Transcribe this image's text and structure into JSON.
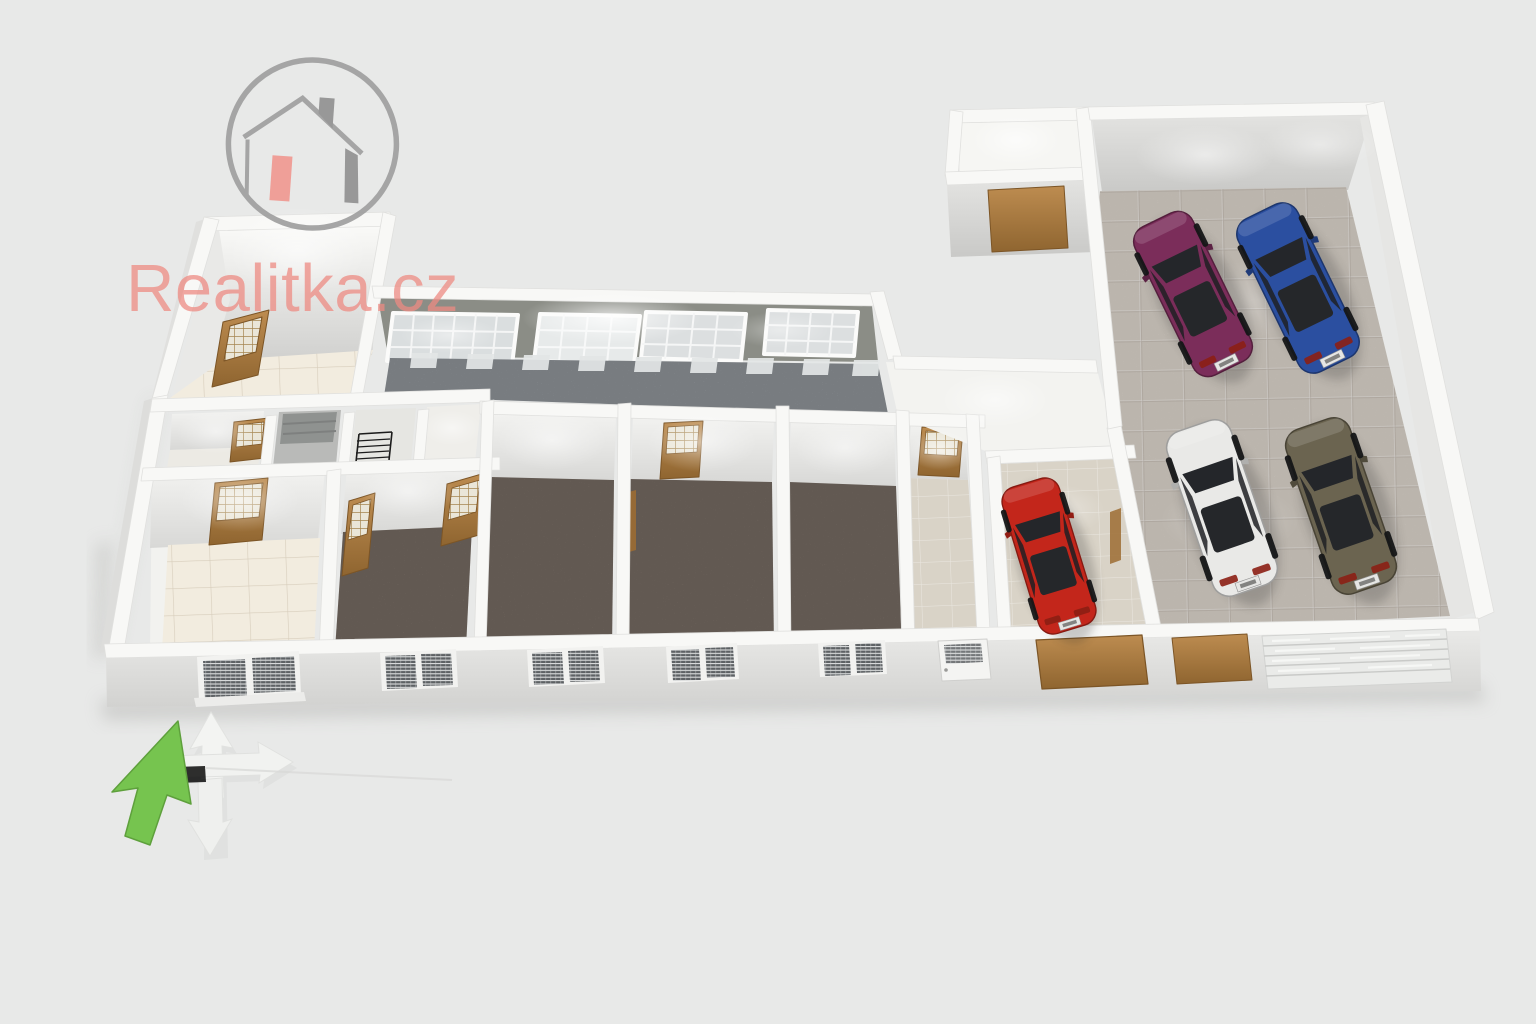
{
  "watermark": {
    "brand_text": "Realitka.cz",
    "brand_color": "#EE8B83",
    "logo_circle_color": "#9B9B9B",
    "logo_house_color": "#8C8C8C",
    "logo_door_color": "#F0958D"
  },
  "compass": {
    "north_arrow_color": "#76C44F",
    "cross_arrows_color": "#F2F3F1"
  },
  "palette": {
    "background": "#E8E9E8",
    "wall_top": "#F8F8F6",
    "wall_face": "#DBDBD9",
    "carpet": "#8E8177",
    "cream_tile": "#F2ECDF",
    "beige_tile": "#D9D3C7",
    "garage_tile": "#D6CFC6",
    "corridor_floor": "#A7ADB3",
    "corridor_wall": "#8B8D86",
    "door_wood": "#B5813F",
    "door_wood_dark": "#8F6530"
  },
  "cars": [
    {
      "name": "maroon-car",
      "body_color": "#7B2D5A"
    },
    {
      "name": "blue-car",
      "body_color": "#2B4FA0"
    },
    {
      "name": "white-car",
      "body_color": "#E9E9E7"
    },
    {
      "name": "olive-car",
      "body_color": "#6B6450"
    },
    {
      "name": "red-car",
      "body_color": "#C3261B"
    }
  ]
}
